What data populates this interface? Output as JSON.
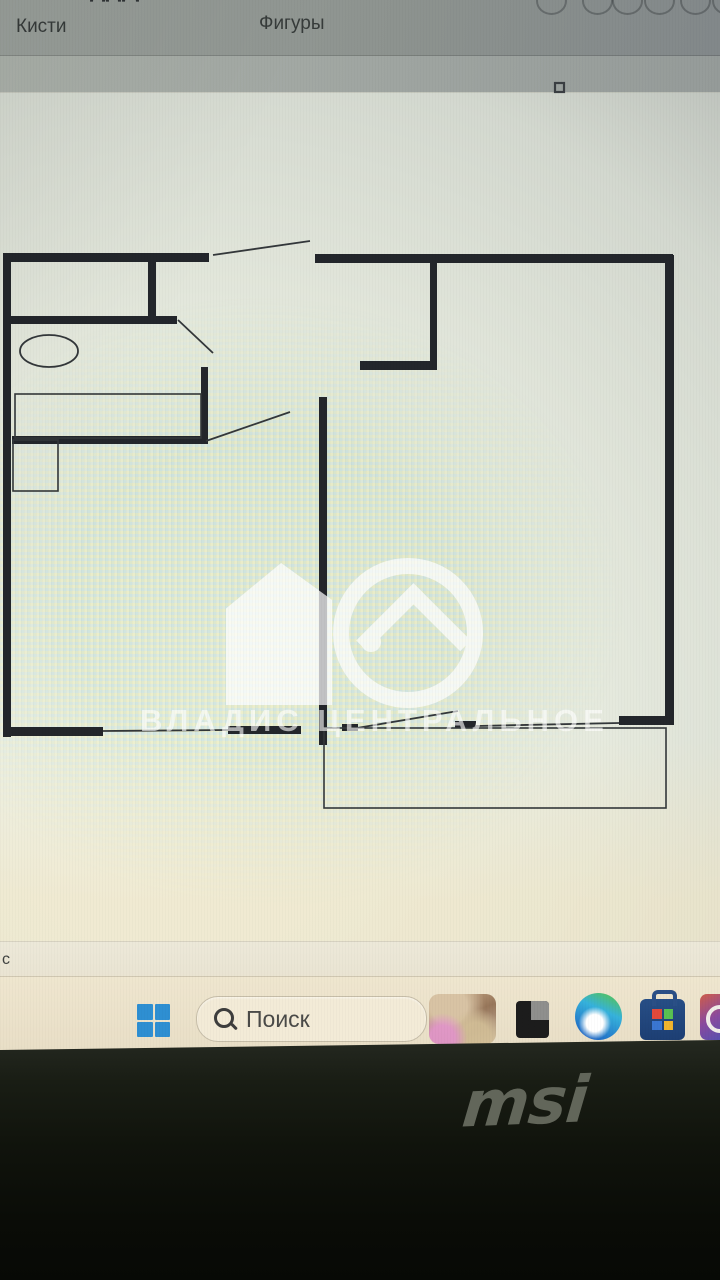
{
  "app": {
    "ribbon": {
      "brushes_label": "Кисти",
      "shapes_label": "Фигуры",
      "shape_gallery_ovals": 6
    },
    "status_bar": {
      "text": "с"
    }
  },
  "canvas": {
    "watermark": {
      "text": "ВЛАДИС ЦЕНТРАЛЬНОЕ",
      "color": "#ffffff"
    },
    "floorplan": {
      "wall_color": "#23262b",
      "line_color": "#33373a",
      "walls": [
        {
          "x": 3,
          "y": 253,
          "w": 8,
          "h": 484
        },
        {
          "x": 3,
          "y": 253,
          "w": 206,
          "h": 9
        },
        {
          "x": 315,
          "y": 254,
          "w": 358,
          "h": 9
        },
        {
          "x": 665,
          "y": 255,
          "w": 9,
          "h": 469
        },
        {
          "x": 619,
          "y": 716,
          "w": 55,
          "h": 9
        },
        {
          "x": 11,
          "y": 727,
          "w": 92,
          "h": 9
        },
        {
          "x": 228,
          "y": 726,
          "w": 73,
          "h": 8
        },
        {
          "x": 342,
          "y": 724,
          "w": 16,
          "h": 7
        },
        {
          "x": 455,
          "y": 721,
          "w": 21,
          "h": 7
        },
        {
          "x": 148,
          "y": 255,
          "w": 8,
          "h": 66
        },
        {
          "x": 5,
          "y": 316,
          "w": 172,
          "h": 8
        },
        {
          "x": 201,
          "y": 367,
          "w": 7,
          "h": 77
        },
        {
          "x": 12,
          "y": 436,
          "w": 195,
          "h": 8
        },
        {
          "x": 430,
          "y": 262,
          "w": 7,
          "h": 106
        },
        {
          "x": 360,
          "y": 361,
          "w": 77,
          "h": 9
        },
        {
          "x": 319,
          "y": 397,
          "w": 8,
          "h": 348
        }
      ],
      "lines": [
        {
          "x1": 213,
          "y1": 255,
          "x2": 310,
          "y2": 241
        },
        {
          "x1": 178,
          "y1": 320,
          "x2": 213,
          "y2": 353
        },
        {
          "x1": 206,
          "y1": 441,
          "x2": 290,
          "y2": 412
        },
        {
          "x1": 103,
          "y1": 731,
          "x2": 228,
          "y2": 730
        },
        {
          "x1": 476,
          "y1": 726,
          "x2": 619,
          "y2": 723
        },
        {
          "x1": 357,
          "y1": 728,
          "x2": 458,
          "y2": 711
        }
      ],
      "outline_rects": [
        {
          "x": 15,
          "y": 394,
          "w": 186,
          "h": 44
        },
        {
          "x": 13,
          "y": 440,
          "w": 45,
          "h": 51
        },
        {
          "x": 324,
          "y": 728,
          "w": 342,
          "h": 80
        }
      ],
      "ellipses": [
        {
          "cx": 49,
          "cy": 351,
          "rx": 29,
          "ry": 16
        }
      ],
      "resize_handle": {
        "x": 555,
        "y": 83,
        "w": 9,
        "h": 9
      }
    }
  },
  "taskbar": {
    "search": {
      "placeholder": "Поиск"
    },
    "start_color": "#2e8fd2",
    "icons": [
      {
        "name": "start-button",
        "glyph": "windows-logo"
      },
      {
        "name": "search-box",
        "glyph": "magnifier"
      },
      {
        "name": "widgets-button",
        "glyph": "photo-thumbnail"
      },
      {
        "name": "dark-app-icon",
        "glyph": "black-square"
      },
      {
        "name": "edge-browser-icon",
        "glyph": "edge-swirl"
      },
      {
        "name": "store-icon",
        "glyph": "shopping-bag"
      },
      {
        "name": "clipped-app-icon",
        "glyph": "white-ring"
      }
    ]
  },
  "bezel": {
    "brand": "msi"
  }
}
